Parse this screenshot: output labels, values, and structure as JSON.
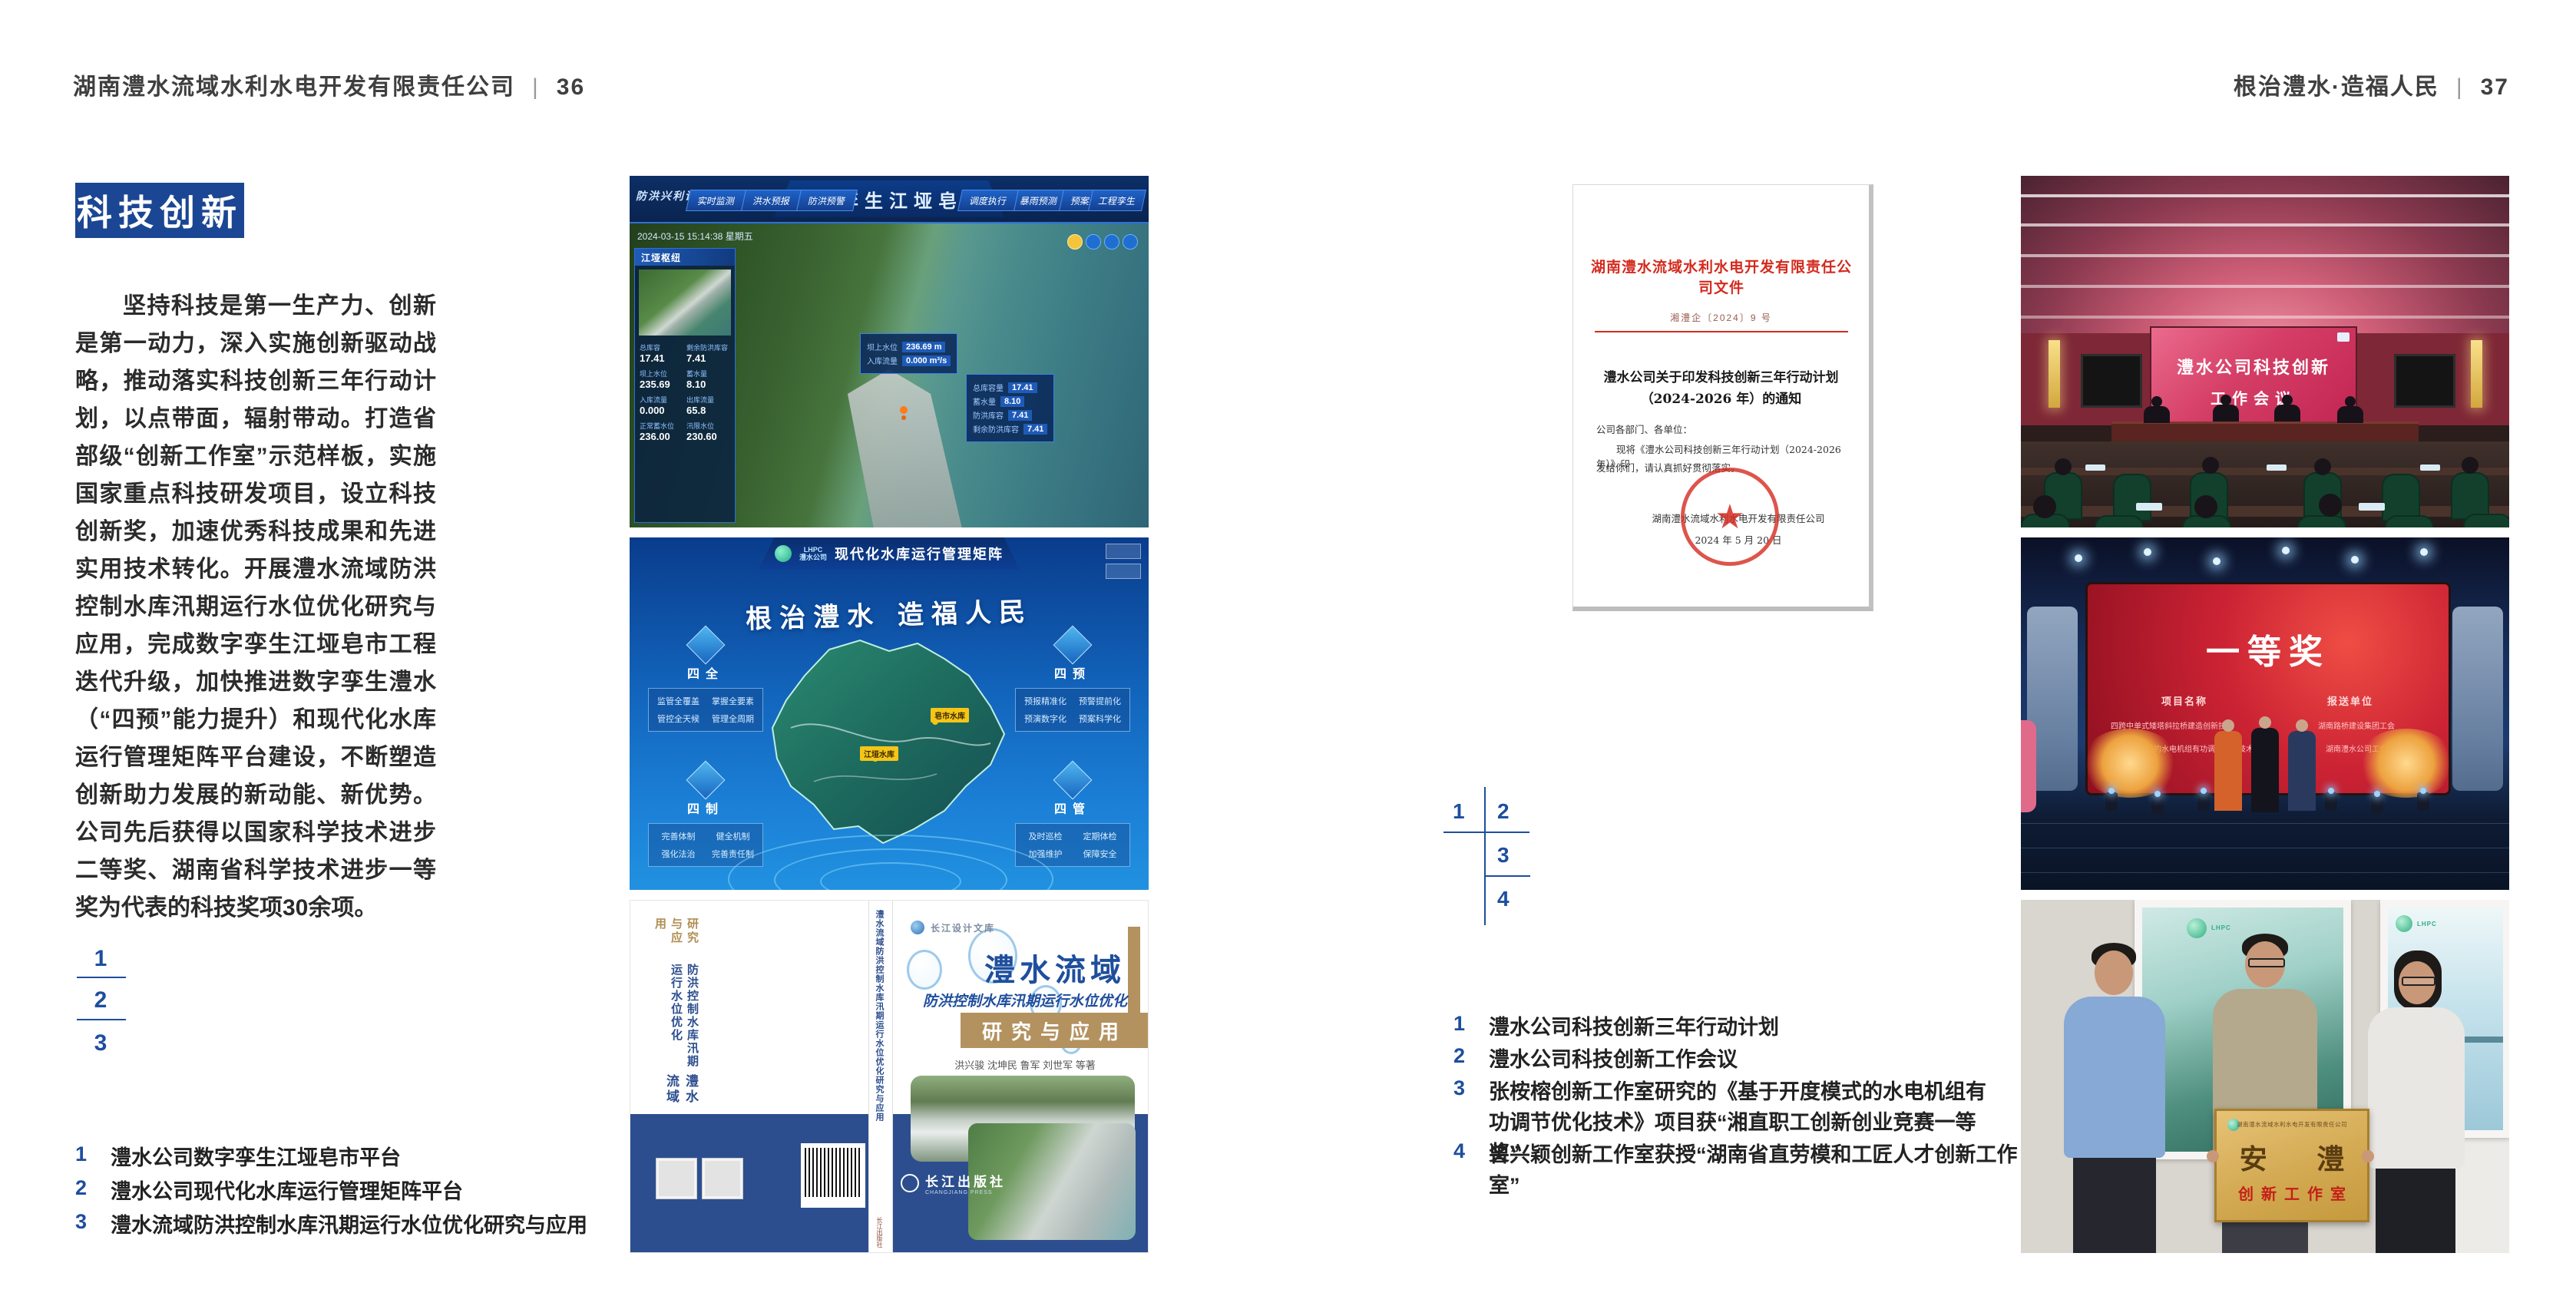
{
  "colors": {
    "accent_blue": "#1b4693",
    "number_blue": "#1d4e9e",
    "doc_red": "#d42a1e",
    "screen_red": "#c21f36",
    "gold": "#c9a355"
  },
  "left_page": {
    "header": {
      "company": "湖南澧水流域水利水电开发有限责任公司",
      "divider": "|",
      "page": "36"
    },
    "section_title": "科技创新",
    "body": "坚持科技是第一生产力、创新是第一动力，深入实施创新驱动战略，推动落实科技创新三年行动计划，以点带面，辐射带动。打造省部级“创新工作室”示范样板，实施国家重点科技研发项目，设立科技创新奖，加速优秀科技成果和先进实用技术转化。开展澧水流域防洪控制水库汛期运行水位优化研究与应用，完成数字孪生江垭皂市工程迭代升级，加快推进数字孪生澧水（“四预”能力提升）和现代化水库运行管理矩阵平台建设，不断塑造创新助力发展的新动能、新优势。公司先后获得以国家科学技术进步二等奖、湖南省科学技术进步一等奖为代表的科技奖项30余项。",
    "keys": [
      "1",
      "2",
      "3"
    ],
    "captions": [
      {
        "n": "1",
        "t": "澧水公司数字孪生江垭皂市平台"
      },
      {
        "n": "2",
        "t": "澧水公司现代化水库运行管理矩阵平台"
      },
      {
        "n": "3",
        "t": "澧水流域防洪控制水库汛期运行水位优化研究与应用"
      }
    ],
    "dashboard": {
      "title": "数字孪生江垭皂市",
      "corner": "防洪兴利调度",
      "tabs_left": [
        "实时监测",
        "洪水预报",
        "防洪预警"
      ],
      "tabs_right": [
        "暴雨预测",
        "预案生成",
        "调度执行",
        "工程孪生"
      ],
      "datetime": "2024-03-15 15:14:38 星期五",
      "panel_title": "江垭枢纽",
      "panel_stats": [
        {
          "k": "总库容",
          "v": "17.41"
        },
        {
          "k": "剩余防洪库容",
          "v": "7.41"
        },
        {
          "k": "坝上水位",
          "v": "235.69"
        },
        {
          "k": "蓄水量",
          "v": "8.10"
        },
        {
          "k": "入库流量",
          "v": "0.000"
        },
        {
          "k": "出库流量",
          "v": "65.8"
        },
        {
          "k": "正常蓄水位",
          "v": "236.00"
        },
        {
          "k": "汛限水位",
          "v": "230.60"
        }
      ],
      "tip1": {
        "k1": "坝上水位",
        "v1": "236.69 m",
        "k2": "入库流量",
        "v2": "0.000 m³/s"
      },
      "tip2": [
        {
          "k": "总库容量",
          "v": "17.41"
        },
        {
          "k": "蓄水量",
          "v": "8.10"
        },
        {
          "k": "防洪库容",
          "v": "7.41"
        },
        {
          "k": "剩余防洪库容",
          "v": "7.41"
        }
      ]
    },
    "matrix": {
      "logo": "LHPC",
      "logo_sub": "澧水公司",
      "title": "现代化水库运行管理矩阵",
      "slogan": "根治澧水 造福人民",
      "groups": [
        {
          "name": "四全",
          "items": [
            "监管全覆盖",
            "掌握全要素",
            "管控全天候",
            "管理全周期"
          ]
        },
        {
          "name": "四预",
          "items": [
            "预报精准化",
            "预警提前化",
            "预演数字化",
            "预案科学化"
          ]
        },
        {
          "name": "四制",
          "items": [
            "完善体制",
            "健全机制",
            "强化法治",
            "完善责任制"
          ]
        },
        {
          "name": "四管",
          "items": [
            "及时巡检",
            "定期体检",
            "加强维护",
            "保障安全"
          ]
        }
      ],
      "map_labels": [
        "皂市水库",
        "江垭水库"
      ]
    },
    "book": {
      "series": "长江设计文库",
      "title": "澧水流域",
      "subtitle": "防洪控制水库汛期运行水位优化",
      "band": "研究与应用",
      "authors": "洪兴骏 沈坤民 鲁军 刘世军 等著",
      "publisher": "长江出版社",
      "publisher_en": "CHANGJIANG PRESS",
      "spine": "澧水流域防洪控制水库汛期运行水位优化研究与应用",
      "back_line1": "澧水流域",
      "back_line2": "防洪控制水库汛期运行水位优化",
      "back_line3": "研究与应用"
    }
  },
  "right_page": {
    "header": {
      "motto": "根治澧水·造福人民",
      "divider": "|",
      "page": "37"
    },
    "keys": [
      "1",
      "2",
      "3",
      "4"
    ],
    "captions": [
      {
        "n": "1",
        "t": "澧水公司科技创新三年行动计划"
      },
      {
        "n": "2",
        "t": "澧水公司科技创新工作会议"
      },
      {
        "n": "3",
        "t": "张桉榕创新工作室研究的《基于开度模式的水电机组有功调节优化技术》项目获“湘直职工创新创业竞赛一等奖”"
      },
      {
        "n": "4",
        "t": "曾兴颖创新工作室获授“湖南省直劳模和工匠人才创新工作室”"
      }
    ],
    "document": {
      "header": "湖南澧水流域水利水电开发有限责任公司文件",
      "number": "湘澧企〔2024〕9 号",
      "title_line1": "澧水公司关于印发科技创新三年行动计划",
      "title_line2": "（2024-2026 年）的通知",
      "salutation": "公司各部门、各单位：",
      "body_line1": "现将《澧水公司科技创新三年行动计划（2024-2026 年）》印",
      "body_line2": "发给你们，请认真抓好贯彻落实。",
      "signer": "湖南澧水流域水利水电开发有限责任公司",
      "date": "2024 年 5 月 20 日",
      "seal_star": "★"
    },
    "meeting": {
      "screen_line1": "澧水公司科技创新",
      "screen_line2": "工作会议"
    },
    "award": {
      "title": "一等奖",
      "col1_header": "项目名称",
      "col2_header": "报送单位",
      "col1_rows": [
        "四跨中单式矮塔斜拉桥建造创新技术",
        "基于开度模式的水电机组有功调节优化技术"
      ],
      "col2_rows": [
        "湖南路桥建设集团工会",
        "湖南澧水公司工会"
      ]
    },
    "group": {
      "plaque_org": "湖南澧水流域水利水电开发有限责任公司",
      "plaque_title": "安 澧",
      "plaque_sub": "创新工作室",
      "poster_logo": "LHPC"
    }
  }
}
